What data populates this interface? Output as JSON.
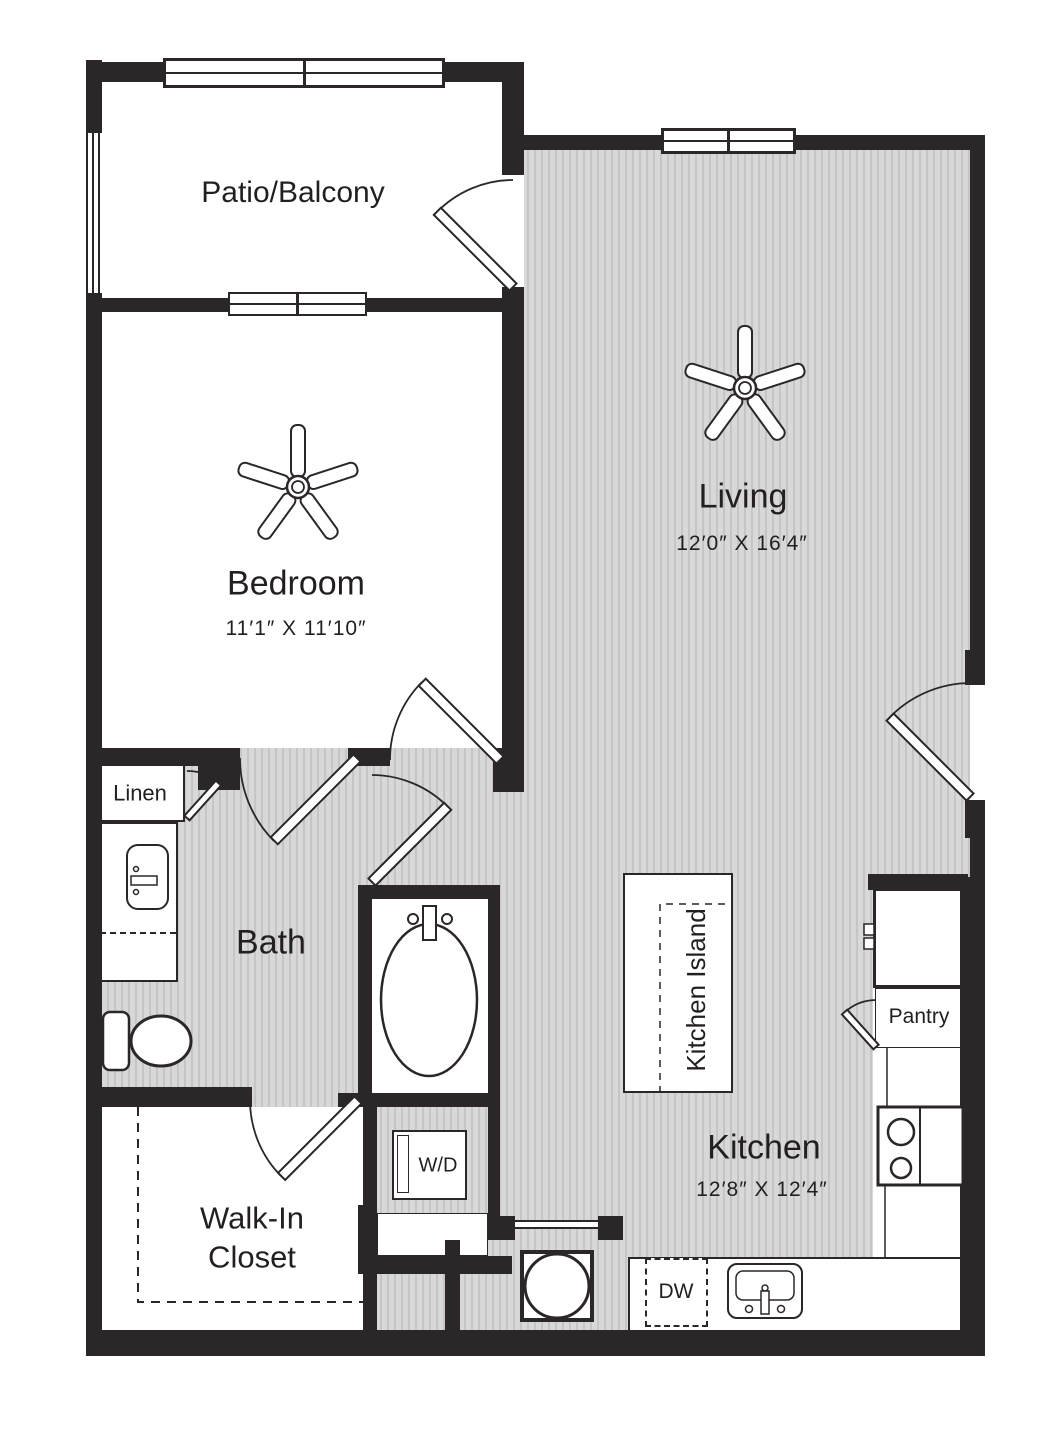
{
  "plan": {
    "rooms": {
      "patio": {
        "label": "Patio/Balcony"
      },
      "bedroom": {
        "label": "Bedroom",
        "dims": "11′1″ X 11′10″"
      },
      "living": {
        "label": "Living",
        "dims": "12′0″ X 16′4″"
      },
      "bath": {
        "label": "Bath"
      },
      "kitchen": {
        "label": "Kitchen",
        "dims": "12′8″ X 12′4″"
      },
      "closet": {
        "label": "Walk-In\nCloset"
      },
      "linen": {
        "label": "Linen"
      },
      "pantry": {
        "label": "Pantry"
      },
      "kitchen_island": {
        "label": "Kitchen Island"
      }
    },
    "appliances": {
      "washer_dryer": {
        "label": "W/D"
      },
      "dishwasher": {
        "label": "DW"
      }
    },
    "colors": {
      "wall": "#2b2627",
      "text": "#231f20",
      "floor_light": "#d8d8d8",
      "floor_dark": "#c5c5c5"
    }
  }
}
